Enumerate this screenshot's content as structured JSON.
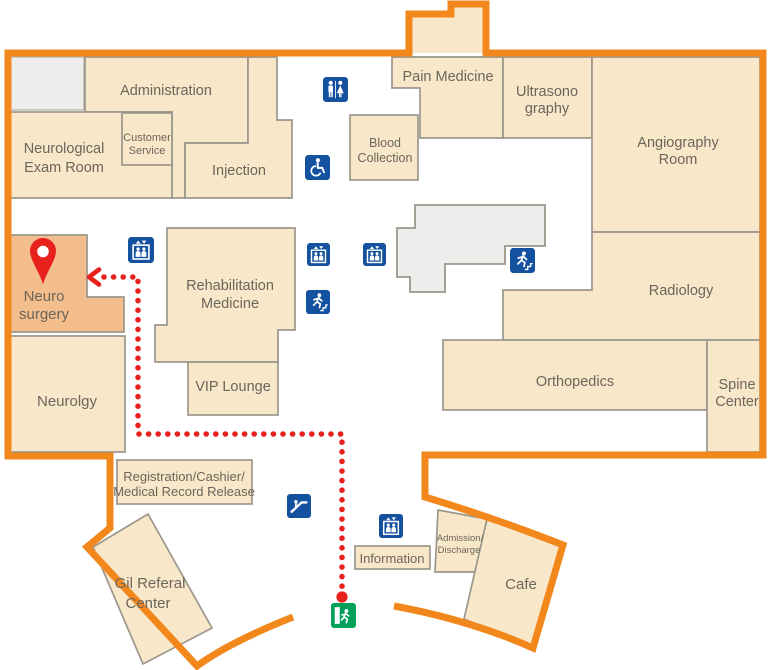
{
  "map": {
    "colors": {
      "outline_orange": "#f2871c",
      "room_fill": "#f8e7c8",
      "room_stroke": "#9b978c",
      "highlight_room_fill": "#f3bd8c",
      "icon_blue": "#14519e",
      "route_red": "#e8211d",
      "exit_green": "#00a05a",
      "structure_gray": "#ededeb",
      "label_color": "#6b665c"
    },
    "rooms": [
      {
        "id": "administration",
        "lines": [
          "Administration"
        ]
      },
      {
        "id": "neurological-exam-room",
        "lines": [
          "Neurological",
          "Exam Room"
        ]
      },
      {
        "id": "customer-service",
        "lines": [
          "Customer",
          "Service"
        ]
      },
      {
        "id": "injection",
        "lines": [
          "Injection"
        ]
      },
      {
        "id": "pain-medicine",
        "lines": [
          "Pain Medicine"
        ]
      },
      {
        "id": "ultrasonography",
        "lines": [
          "Ultrasono",
          "graphy"
        ]
      },
      {
        "id": "angiography-room",
        "lines": [
          "Angiography",
          "Room"
        ]
      },
      {
        "id": "blood-collection",
        "lines": [
          "Blood",
          "Collection"
        ]
      },
      {
        "id": "rehabilitation-medicine",
        "lines": [
          "Rehabilitation",
          "Medicine"
        ]
      },
      {
        "id": "neuro-surgery",
        "lines": [
          "Neuro",
          "surgery"
        ],
        "highlighted": true
      },
      {
        "id": "vip-lounge",
        "lines": [
          "VIP Lounge"
        ]
      },
      {
        "id": "neurolgy",
        "lines": [
          "Neurolgy"
        ]
      },
      {
        "id": "radiology",
        "lines": [
          "Radiology"
        ]
      },
      {
        "id": "orthopedics",
        "lines": [
          "Orthopedics"
        ]
      },
      {
        "id": "spine-center",
        "lines": [
          "Spine",
          "Center"
        ]
      },
      {
        "id": "registration-cashier",
        "lines": [
          "Registration/Cashier/",
          "Medical Record Release"
        ]
      },
      {
        "id": "gil-referal-center",
        "lines": [
          "Gil Referal",
          "Center"
        ]
      },
      {
        "id": "information",
        "lines": [
          "Information"
        ]
      },
      {
        "id": "admission-discharge",
        "lines": [
          "Admission/",
          "Discharge"
        ]
      },
      {
        "id": "cafe",
        "lines": [
          "Cafe"
        ]
      }
    ],
    "icons": [
      {
        "name": "restroom"
      },
      {
        "name": "wheelchair-accessible"
      },
      {
        "name": "elevator"
      },
      {
        "name": "elevator"
      },
      {
        "name": "elevator"
      },
      {
        "name": "elevator"
      },
      {
        "name": "emergency-exit"
      },
      {
        "name": "emergency-exit"
      },
      {
        "name": "escalator"
      },
      {
        "name": "exit"
      },
      {
        "name": "destination-pin"
      }
    ],
    "route": {
      "style": "dotted",
      "color": "#e8211d",
      "destination": "Neuro surgery"
    }
  }
}
